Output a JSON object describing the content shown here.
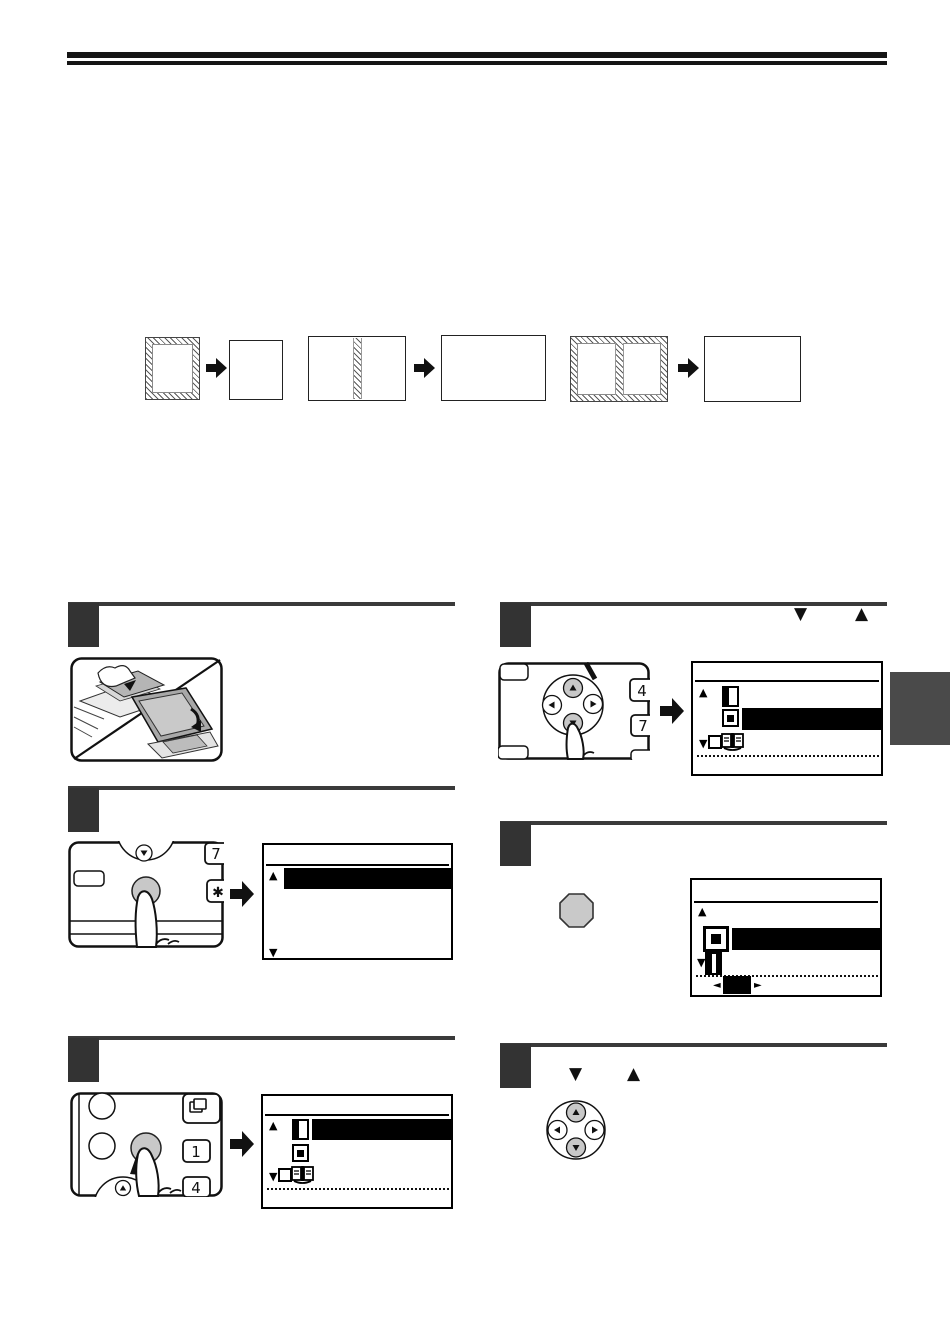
{
  "page": {
    "width": 950,
    "height": 1341,
    "background": "#ffffff",
    "kind": "copier-manual-instruction-page",
    "visible_text": "none (text layer absent; only key caps and arrow glyphs rendered)"
  },
  "colors": {
    "ink": "#111111",
    "step_rule": "#3a3a3a",
    "step_box": "#333333",
    "key_gray": "#c8c8c8",
    "chapter_tab": "#4a4a4a",
    "highlight": "#000000",
    "paper_gray": "#b5b5b5"
  },
  "glyphs": {
    "up": "▲",
    "down": "▼",
    "left": "◄",
    "right": "►"
  },
  "panel_keys": {
    "seven": "7",
    "asterisk": "✱",
    "one": "1",
    "four": "4"
  },
  "header": {
    "type": "double-horizontal-rule"
  },
  "overview": {
    "description": "three before/after erase examples, each original -> copy with arrow",
    "sequences": [
      {
        "original": "portrait-sheet-hatched-border",
        "result": "portrait-sheet-plain"
      },
      {
        "original": "landscape-sheet-hatched-center-strip",
        "result": "landscape-sheet-plain"
      },
      {
        "original": "landscape-sheet-hatched-border-and-center-strip",
        "result": "landscape-sheet-plain"
      }
    ]
  },
  "steps": [
    {
      "n": 1,
      "column": "left",
      "content": "illustration: placing original in document feeder or on document glass (diagonal split drawing)"
    },
    {
      "n": 2,
      "column": "left",
      "panel": {
        "keys": [
          "7",
          "✱"
        ],
        "pressed": "gray round key"
      },
      "lcd": {
        "rows": [
          {
            "icon": null,
            "highlighted": true
          }
        ],
        "scroll_up": "▲",
        "scroll_down": "▼"
      }
    },
    {
      "n": 3,
      "column": "left",
      "panel": {
        "keys": [
          "1",
          "4"
        ],
        "copy_key_icon": true,
        "pressed": "gray round key"
      },
      "lcd": {
        "rows": [
          {
            "icon": "margin-shift",
            "highlighted": true
          },
          {
            "icon": "erase",
            "highlighted": false
          },
          {
            "icon": "dual-page-copy",
            "highlighted": false
          }
        ],
        "dotted_divider": true
      }
    },
    {
      "n": 4,
      "column": "right",
      "heading_glyphs": [
        "▼",
        "▲"
      ],
      "panel": {
        "keys": [
          "4",
          "7"
        ],
        "arrow_pad": {
          "up": "▲",
          "left": "◄",
          "right": "►",
          "down": "▼"
        },
        "pressed": "down arrow key"
      },
      "lcd": {
        "rows": [
          {
            "icon": "margin-shift",
            "highlighted": false
          },
          {
            "icon": "erase",
            "highlighted": true
          },
          {
            "icon": "dual-page-copy",
            "highlighted": false
          }
        ],
        "dotted_divider": true
      }
    },
    {
      "n": 5,
      "column": "right",
      "inline_icon": "octagon-ok-key",
      "lcd": {
        "rows": [
          {
            "icon": "edge-erase",
            "highlighted": true
          },
          {
            "icon": "center-erase",
            "highlighted": false
          }
        ],
        "dotted_divider": true,
        "value_selector": {
          "left": "◄",
          "right": "►",
          "value": "filled-box"
        }
      }
    },
    {
      "n": 6,
      "column": "right",
      "heading_glyphs": [
        "▼",
        "▲"
      ],
      "inline_icon": "arrow-pad (up/down shaded)"
    }
  ],
  "chapter_tab": {
    "present": true,
    "edge": "right",
    "color": "#4a4a4a"
  }
}
